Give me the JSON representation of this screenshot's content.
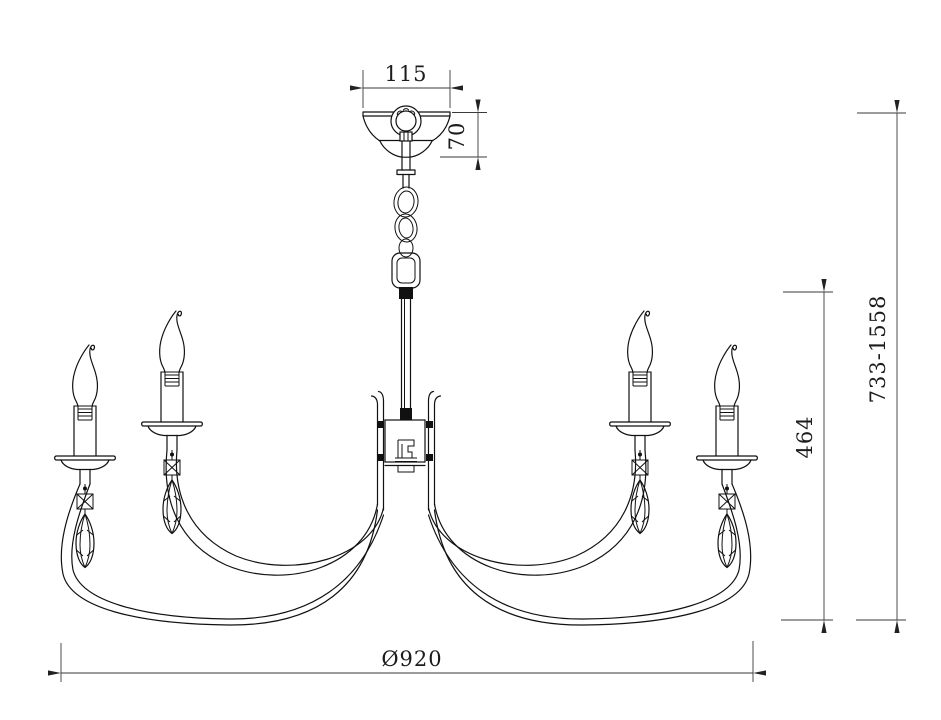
{
  "drawing": {
    "subject": "chandelier-technical-drawing",
    "background_color": "#ffffff",
    "line_color": "#111111",
    "dimension_line_color": "#3a3a3a"
  },
  "dimensions": {
    "canopy_width": {
      "label": "115",
      "orientation": "horizontal"
    },
    "canopy_height": {
      "label": "70",
      "orientation": "vertical"
    },
    "overall_height_range": {
      "label": "733-1558",
      "orientation": "vertical"
    },
    "body_height": {
      "label": "464",
      "orientation": "vertical"
    },
    "diameter": {
      "label": "Ø920",
      "orientation": "horizontal"
    }
  }
}
